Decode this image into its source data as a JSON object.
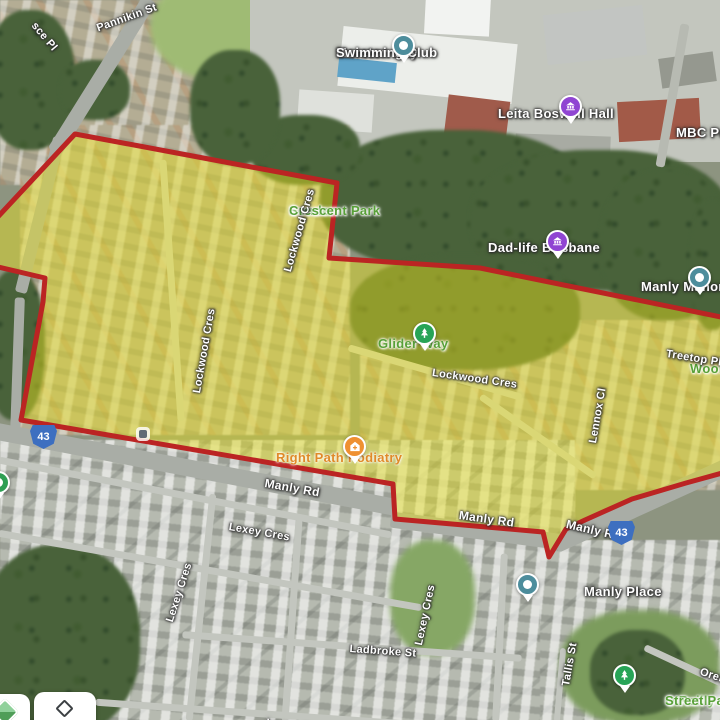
{
  "overlay": {
    "description": "highlighted selection area outlined in red with yellow fill",
    "fill": "#e8e11c",
    "stroke": "#bb2423",
    "opacity": "0.46",
    "points": "75,134 337,183 329,258 480,268 726,318 726,472 686,483 632,499 585,520 566,529 549,557 543,532 395,519 393,484 21,420 43,302 45,278 -6,266 -6,221"
  },
  "pois": [
    {
      "id": "moreton-bay-swimming-club",
      "line1": "Moreton Bay",
      "line2": "Swimming Club",
      "pin_color": "#4d8d9c"
    },
    {
      "id": "leita-boswell-hall",
      "line1": "Leita Boswell Hall",
      "pin_color": "#9045d2"
    },
    {
      "id": "mbc-primary",
      "line1": "MBC Primary"
    },
    {
      "id": "dad-life-brisbane",
      "line1": "Dad-life Brisbane",
      "pin_color": "#9045d2"
    },
    {
      "id": "manly-manor",
      "line1": "Manly Manor",
      "pin_color": "#4d8d9c"
    },
    {
      "id": "manly-place",
      "line1": "Manly Place",
      "pin_color": "#4d8d9c"
    }
  ],
  "parks": [
    {
      "id": "senden-crescent-park",
      "line1": "Senden",
      "line2": "Crescent Park"
    },
    {
      "id": "glider-way",
      "line1": "Glider Way",
      "pin_color": "#28a457"
    },
    {
      "id": "wool-partial",
      "line1": "Wool"
    },
    {
      "id": "oreilly-street-park",
      "line1": "O'Reilly",
      "line2": "Street Park",
      "pin_color": "#28a457"
    }
  ],
  "businesses": [
    {
      "id": "right-path-podiatry",
      "line1": "Right Path Podiatry",
      "pin_color": "#ef9031"
    }
  ],
  "streets": [
    {
      "text": "sce Pl"
    },
    {
      "text": "Pannikin St"
    },
    {
      "text": "Lockwood Cres"
    },
    {
      "text": "Lockwood Cres"
    },
    {
      "text": "Lockwood Cres"
    },
    {
      "text": "Manly Rd"
    },
    {
      "text": "Manly Rd"
    },
    {
      "text": "Manly Rd"
    },
    {
      "text": "Lexey Cres"
    },
    {
      "text": "Lexey Cres"
    },
    {
      "text": "Lexey Cres"
    },
    {
      "text": "Ladbroke St"
    },
    {
      "text": "Lexey Cres"
    },
    {
      "text": "Tallis St"
    },
    {
      "text": "Oreilly St"
    },
    {
      "text": "Treetop Pl"
    },
    {
      "text": "Lennox Cl"
    }
  ],
  "route_shields": [
    {
      "label": "43"
    },
    {
      "label": "43"
    }
  ]
}
